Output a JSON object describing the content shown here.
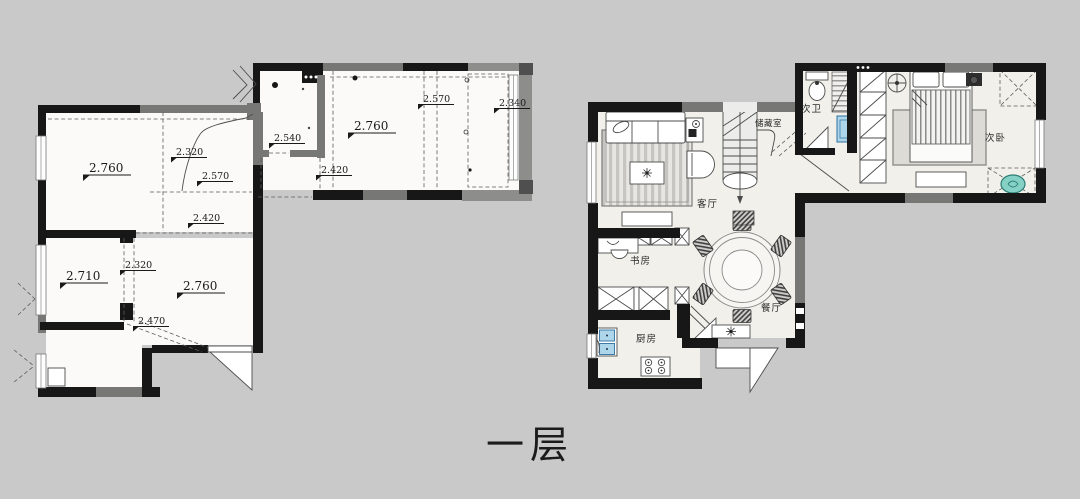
{
  "page": {
    "background": "#c9c9c9",
    "floor_label": "一层"
  },
  "colors": {
    "wall_black": "#171717",
    "wall_gray": "#777776",
    "floor_left_plan": "#fbfaf8",
    "floor_right_plan": "#f1f0ea",
    "fixture_blue": "#aed6ea",
    "ac_teal": "#86d1c6",
    "label_text": "#1a1a1a"
  },
  "left_plan": {
    "height_labels": [
      {
        "value": "2.760"
      },
      {
        "value": "2.320"
      },
      {
        "value": "2.570"
      },
      {
        "value": "2.420"
      },
      {
        "value": "2.540"
      },
      {
        "value": "2.420"
      },
      {
        "value": "2.760"
      },
      {
        "value": "2.570"
      },
      {
        "value": "2.340"
      },
      {
        "value": "2.320"
      },
      {
        "value": "2.710"
      },
      {
        "value": "2.760"
      },
      {
        "value": "2.470"
      }
    ]
  },
  "right_plan": {
    "room_labels": [
      {
        "value": "客厅"
      },
      {
        "value": "储藏室"
      },
      {
        "value": "次卫"
      },
      {
        "value": "次卧"
      },
      {
        "value": "书房"
      },
      {
        "value": "餐厅"
      },
      {
        "value": "厨房"
      }
    ]
  }
}
